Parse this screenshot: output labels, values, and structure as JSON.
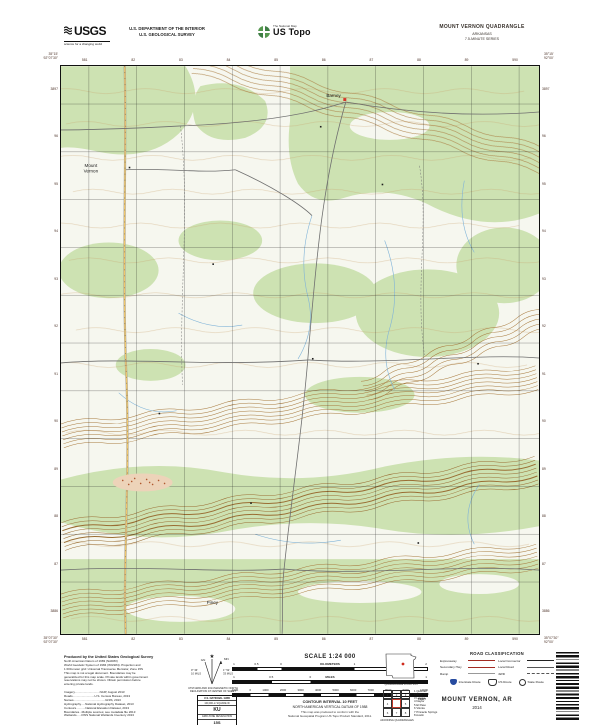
{
  "header": {
    "usgs_logo": {
      "name": "USGS",
      "tagline": "science for a changing world"
    },
    "department_line1": "U.S. DEPARTMENT OF THE INTERIOR",
    "department_line2": "U.S. GEOLOGICAL SURVEY",
    "ustopo": {
      "program": "The National Map",
      "product": "US Topo"
    },
    "quadrangle": {
      "title": "MOUNT VERNON QUADRANGLE",
      "state": "ARKANSAS",
      "series": "7.5-MINUTE SERIES"
    }
  },
  "map": {
    "corners": {
      "top_left": [
        "35°15'",
        "92°07'30\""
      ],
      "top_right": [
        "35°15'",
        "92°00'"
      ],
      "bottom_left": [
        "35°07'30\"",
        "92°07'30\""
      ],
      "bottom_right": [
        "35°07'30\"",
        "92°00'"
      ]
    },
    "grid": {
      "eastings": [
        "581",
        "82",
        "83",
        "84",
        "85",
        "86",
        "87",
        "88",
        "89",
        "590"
      ],
      "northings": [
        "3897",
        "96",
        "95",
        "94",
        "93",
        "92",
        "91",
        "90",
        "89",
        "88",
        "87",
        "3886"
      ]
    },
    "labels": {
      "town_north": "Barney",
      "town_west_line1": "Mount",
      "town_west_line2": "Vernon",
      "town_south": "Piney"
    }
  },
  "footer": {
    "credits_heading": "Produced by the United States Geological Survey",
    "credits": [
      "North American Datum of 1983 (NAD83)",
      "World Geodetic System of 1984 (WGS84). Projection and",
      "1 000-meter grid: Universal Transverse Mercator, Zone 15S",
      "This map is not a legal document. Boundaries may be",
      "generalized for this map scale. Private lands within government",
      "reservations may not be shown. Obtain permission before",
      "entering private lands.",
      "",
      "Imagery..............................NAIP, August 2013",
      "Roads..........................U.S. Census Bureau, 2013",
      "Names......................................GNIS, 2013",
      "Hydrography.....National Hydrography Dataset, 2013",
      "Contours...........National Elevation Dataset, 2013",
      "Boundaries...Multiple sources; see metadata file 2013",
      "Wetlands......FWS National Wetlands Inventory 2013"
    ],
    "declination": {
      "star": "★",
      "gn_label": "GN",
      "mn_label": "MN",
      "gn_value": "0° 33'",
      "gn_mils": "10 MILS",
      "mn_value": "1° 52'",
      "mn_mils": "33 MILS",
      "caption_line1": "UTM GRID AND 2014 MAGNETIC NORTH",
      "caption_line2": "DECLINATION AT CENTER OF SHEET"
    },
    "usng": {
      "title": "U.S. NATIONAL GRID",
      "subtitle": "100,000-m SQUARE ID",
      "square_id": "KU",
      "zone_label": "GRID ZONE DESIGNATION",
      "zone": "15S"
    },
    "scale": {
      "title": "SCALE 1:24 000",
      "bars": [
        {
          "unit": "KILOMETERS",
          "ticks": [
            "1",
            "0.5",
            "0",
            "1",
            "2"
          ]
        },
        {
          "unit": "MILES",
          "ticks": [
            "1",
            "0.5",
            "0",
            "1"
          ]
        },
        {
          "unit": "FEET",
          "ticks": [
            "1000",
            "0",
            "1000",
            "2000",
            "3000",
            "4000",
            "5000",
            "6000",
            "7000",
            "8000",
            "9000",
            "10000"
          ]
        }
      ]
    },
    "contour_note_line1": "CONTOUR INTERVAL 10 FEET",
    "contour_note_line2": "NORTH AMERICAN VERTICAL DATUM OF 1988",
    "standard_note": [
      "This map was produced to conform with the",
      "National Geospatial Program US Topo Product Standard, 2011."
    ],
    "location": {
      "state_caption": "QUADRANGLE LOCATION",
      "adjoining_caption": "ADJOINING QUADRANGLES",
      "adjoining_cells": [
        "1",
        "2",
        "3",
        "4",
        "",
        "5",
        "6",
        "7",
        "8"
      ],
      "adjoining_list": [
        "1 Quitman",
        "2 Rose Bud",
        "3 Letona",
        "4 Naylor",
        "5 El Paso",
        "6 Vilonia",
        "7 Pinnacle Springs",
        "8 Austin"
      ]
    },
    "road_classification": {
      "title": "ROAD CLASSIFICATION",
      "rows": [
        "Expressway",
        "Local Connector",
        "Secondary Hwy",
        "Local Road",
        "Ramp",
        "4WD"
      ],
      "shields": [
        "Interstate Route",
        "US Route",
        "State Route"
      ]
    },
    "sheet_name": "MOUNT VERNON,  AR",
    "sheet_year": "2014",
    "colors": {
      "legend_red": "#a22b22",
      "interstate_blue": "#274b9f",
      "forest_green": "#cde2b2",
      "contour_brown": "#a87a3e"
    }
  }
}
